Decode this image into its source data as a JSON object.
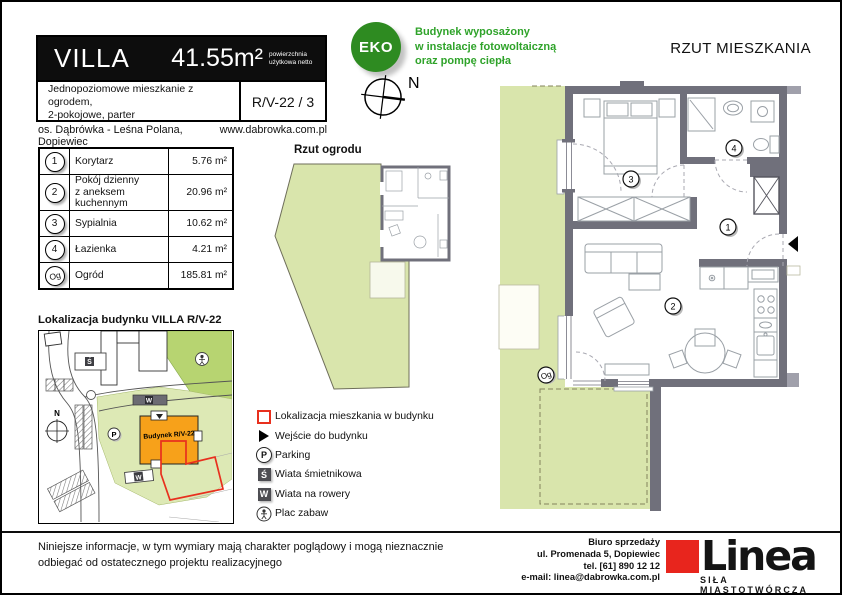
{
  "header": {
    "title": "VILLA",
    "area": "41.55m²",
    "area_note": "powierzchnia użytkowa netto",
    "description_line1": "Jednopoziomowe mieszkanie z ogrodem,",
    "description_line2": "2-pokojowe, parter",
    "unit_code": "R/V-22 / 3",
    "estate": "os. Dąbrówka - Leśna Polana, Dopiewiec",
    "website": "www.dabrowka.com.pl"
  },
  "eco": {
    "badge": "EKO",
    "line1": "Budynek wyposażony",
    "line2": "w instalacje fotowoltaiczną",
    "line3": "oraz pompę ciepła"
  },
  "compass": {
    "north": "N"
  },
  "rooms": [
    {
      "no": "1",
      "name": "Korytarz",
      "name2": "",
      "area": "5.76 m²"
    },
    {
      "no": "2",
      "name": "Pokój dzienny",
      "name2": "z aneksem kuchennym",
      "area": "20.96 m²"
    },
    {
      "no": "3",
      "name": "Sypialnia",
      "name2": "",
      "area": "10.62 m²"
    },
    {
      "no": "4",
      "name": "Łazienka",
      "name2": "",
      "area": "4.21 m²"
    },
    {
      "no": "Og",
      "name": "Ogród",
      "name2": "",
      "area": "185.81 m²"
    }
  ],
  "garden_plan": {
    "title": "Rzut ogrodu"
  },
  "apartment_plan": {
    "title": "RZUT MIESZKANIA",
    "room_labels": {
      "r1": "1",
      "r2": "2",
      "r3": "3",
      "r4": "4",
      "garden": "Og"
    }
  },
  "location_map": {
    "title": "Lokalizacja budynku  VILLA R/V-22",
    "building_label": "Budynek R/V-22",
    "north": "N",
    "parking": "P",
    "trash_badge": "Ś",
    "bike_badge": "W"
  },
  "legend": {
    "items": [
      {
        "icon": "apartment-outline",
        "glyph": "",
        "label": "Lokalizacja mieszkania w budynku"
      },
      {
        "icon": "entrance-arrow",
        "glyph": "",
        "label": "Wejście do budynku"
      },
      {
        "icon": "parking-circle",
        "glyph": "P",
        "label": "Parking"
      },
      {
        "icon": "trash-shelter",
        "glyph": "Ś",
        "label": "Wiata śmietnikowa"
      },
      {
        "icon": "bike-shelter",
        "glyph": "W",
        "label": "Wiata na rowery"
      },
      {
        "icon": "playground",
        "glyph": "",
        "label": "Plac zabaw"
      }
    ]
  },
  "footer": {
    "disclaimer_line1": "Niniejsze informacje, w tym wymiary mają charakter poglądowy i mogą nieznacznie",
    "disclaimer_line2": "odbiegać od ostatecznego projektu realizacyjnego",
    "office_title": "Biuro sprzedaży",
    "office_address": "ul. Promenada 5, Dopiewiec",
    "office_phone": "tel. [61] 890 12 12",
    "office_email": "e-mail: linea@dabrowka.com.pl",
    "logo_text": "Linea",
    "logo_tagline": "SIŁA MIASTOTWÓRCZA"
  },
  "colors": {
    "garden": "#d9e5ac",
    "wall": "#70707b",
    "eco": "#2e8b21",
    "accent_red": "#e8301e",
    "building_orange": "#f7a11a"
  }
}
